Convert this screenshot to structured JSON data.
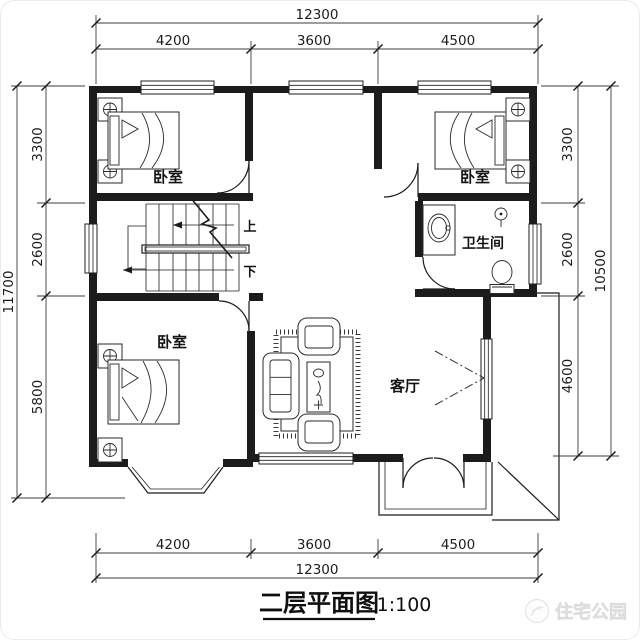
{
  "plan": {
    "title": "二层平面图",
    "scale": "1:100",
    "watermark": "住宅公园",
    "rooms": {
      "bedroom_top_left": "卧室",
      "bedroom_top_right": "卧室",
      "bedroom_bottom_left": "卧室",
      "bathroom": "卫生间",
      "living_room": "客厅"
    },
    "stairs": {
      "up": "上",
      "down": "下"
    },
    "dims": {
      "top": {
        "total": "12300",
        "seg": [
          "4200",
          "3600",
          "4500"
        ]
      },
      "bottom": {
        "total": "12300",
        "seg": [
          "4200",
          "3600",
          "4500"
        ]
      },
      "left": {
        "total": "11700",
        "seg": [
          "3300",
          "2600",
          "5800"
        ]
      },
      "right": {
        "total": "10500",
        "seg": [
          "3300",
          "2600",
          "4600"
        ]
      }
    }
  },
  "colors": {
    "ink": "#1c1c1c",
    "dim": "#3c3c3c",
    "wm": "#e9e9e9",
    "bg": "#ffffff"
  }
}
